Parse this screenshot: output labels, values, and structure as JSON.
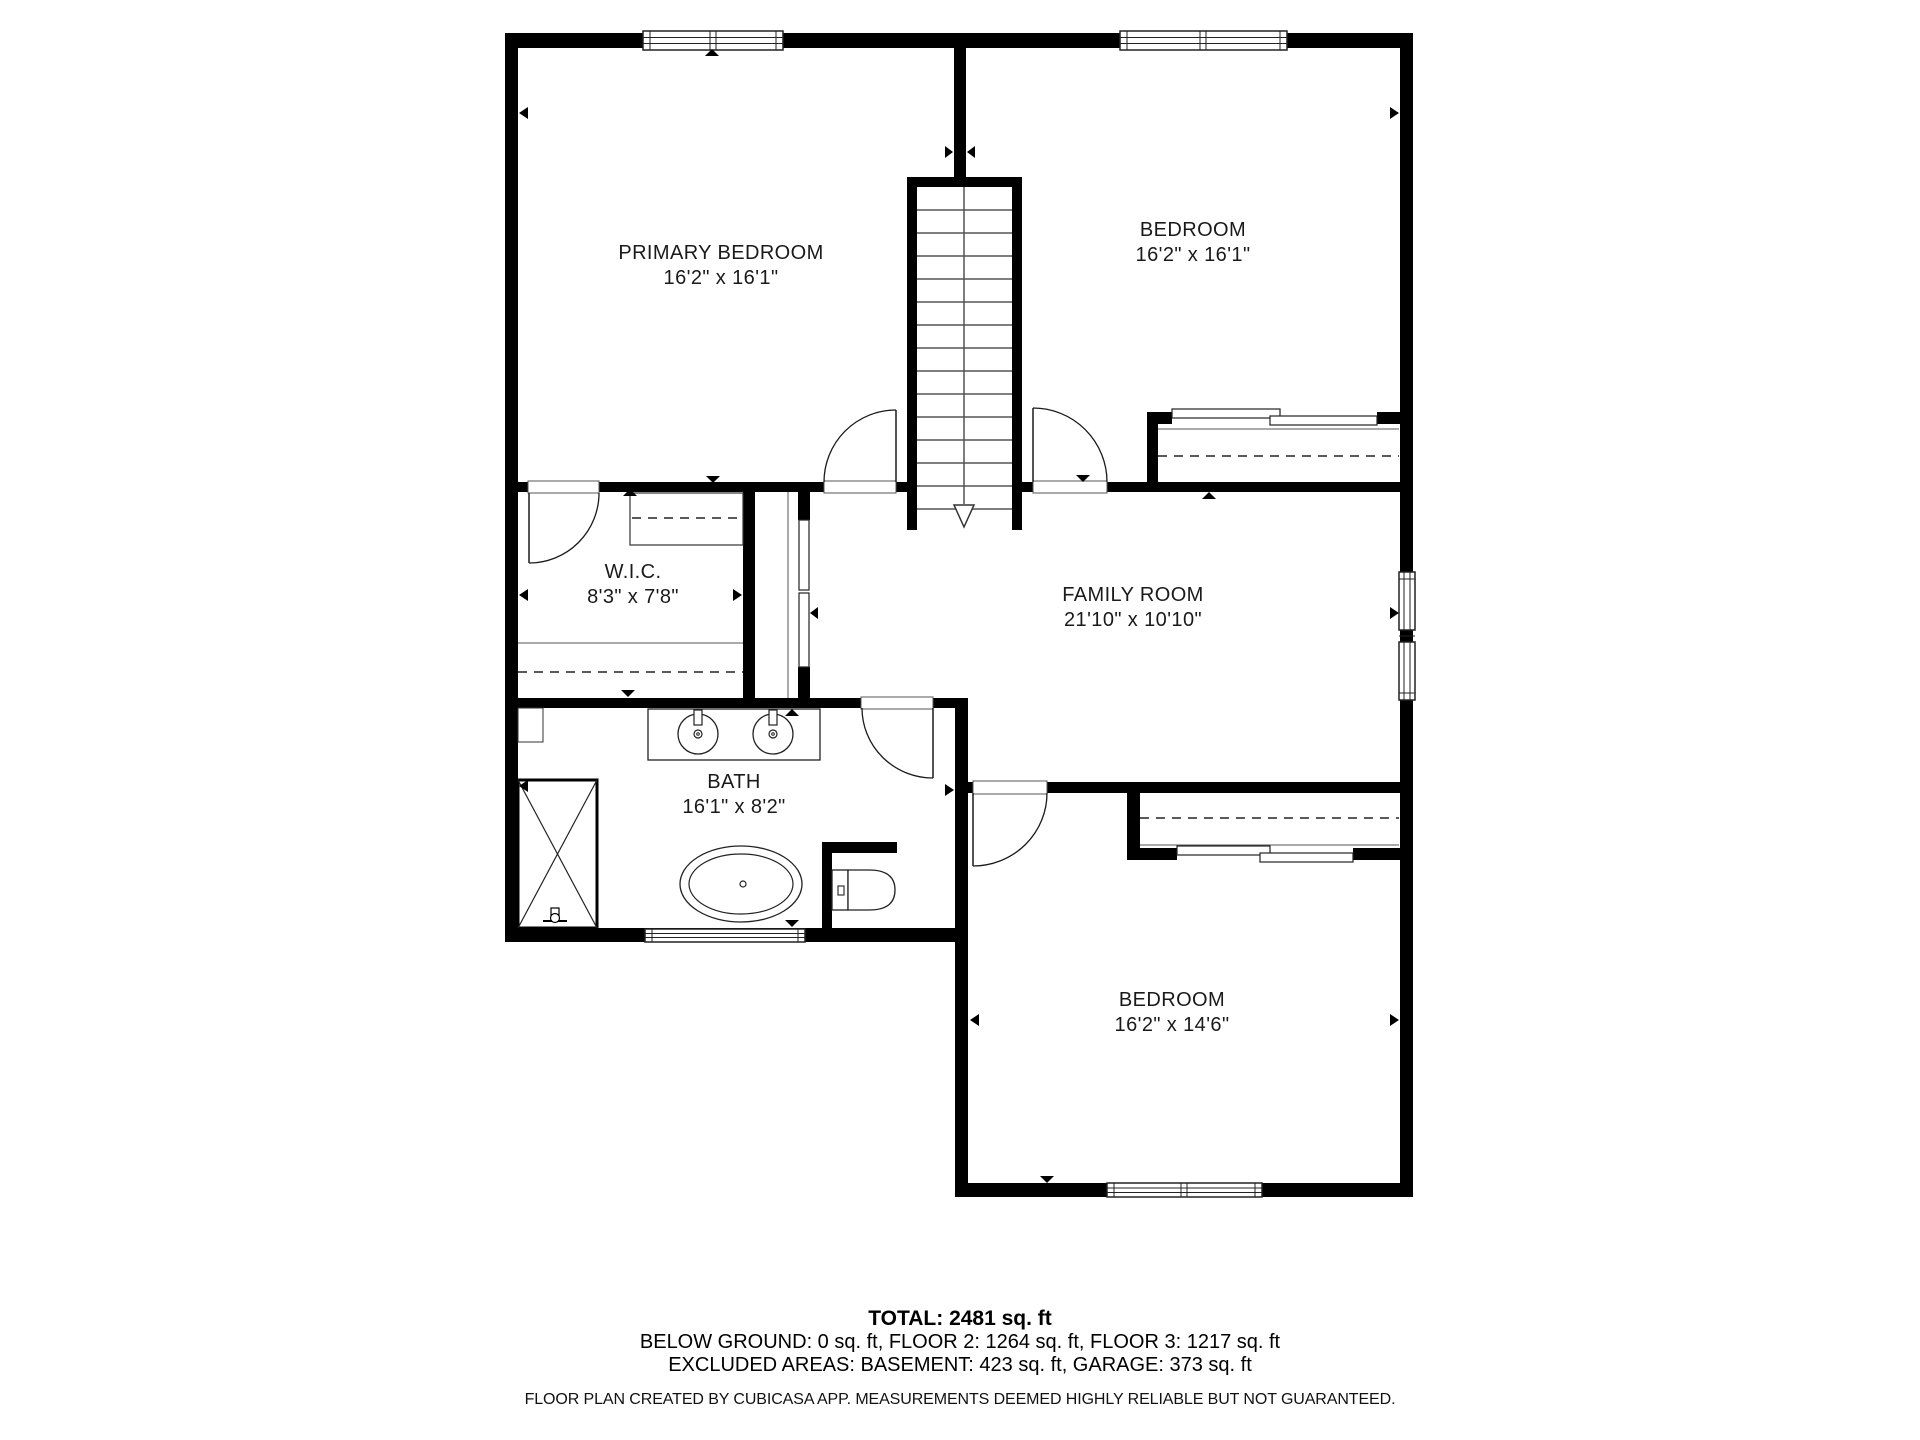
{
  "floor_plan": {
    "rooms": [
      {
        "name": "PRIMARY BEDROOM",
        "dims": "16'2\" x 16'1\""
      },
      {
        "name": "BEDROOM",
        "dims": "16'2\" x 16'1\""
      },
      {
        "name": "W.I.C.",
        "dims": "8'3\" x 7'8\""
      },
      {
        "name": "FAMILY ROOM",
        "dims": "21'10\" x 10'10\""
      },
      {
        "name": "BATH",
        "dims": "16'1\" x 8'2\""
      },
      {
        "name": "BEDROOM",
        "dims": "16'2\" x 14'6\""
      }
    ],
    "summary": {
      "total": "TOTAL: 2481 sq. ft",
      "floors": "BELOW GROUND: 0 sq. ft, FLOOR 2: 1264 sq. ft, FLOOR 3: 1217 sq. ft",
      "excluded": "EXCLUDED AREAS: BASEMENT: 423 sq. ft, GARAGE: 373 sq. ft"
    },
    "footer": "FLOOR PLAN CREATED BY CUBICASA APP. MEASUREMENTS DEEMED HIGHLY RELIABLE BUT NOT GUARANTEED.",
    "colors": {
      "wall": "#000000",
      "background": "#ffffff",
      "text": "#1a1a1a"
    },
    "fixtures": [
      "staircase-down-arrow",
      "double-sink-vanity",
      "freestanding-bathtub",
      "toilet",
      "shower-with-cross",
      "sliding-closet-doors",
      "hanging-rod-dashed",
      "swing-doors",
      "windows",
      "dimension-markers"
    ]
  }
}
